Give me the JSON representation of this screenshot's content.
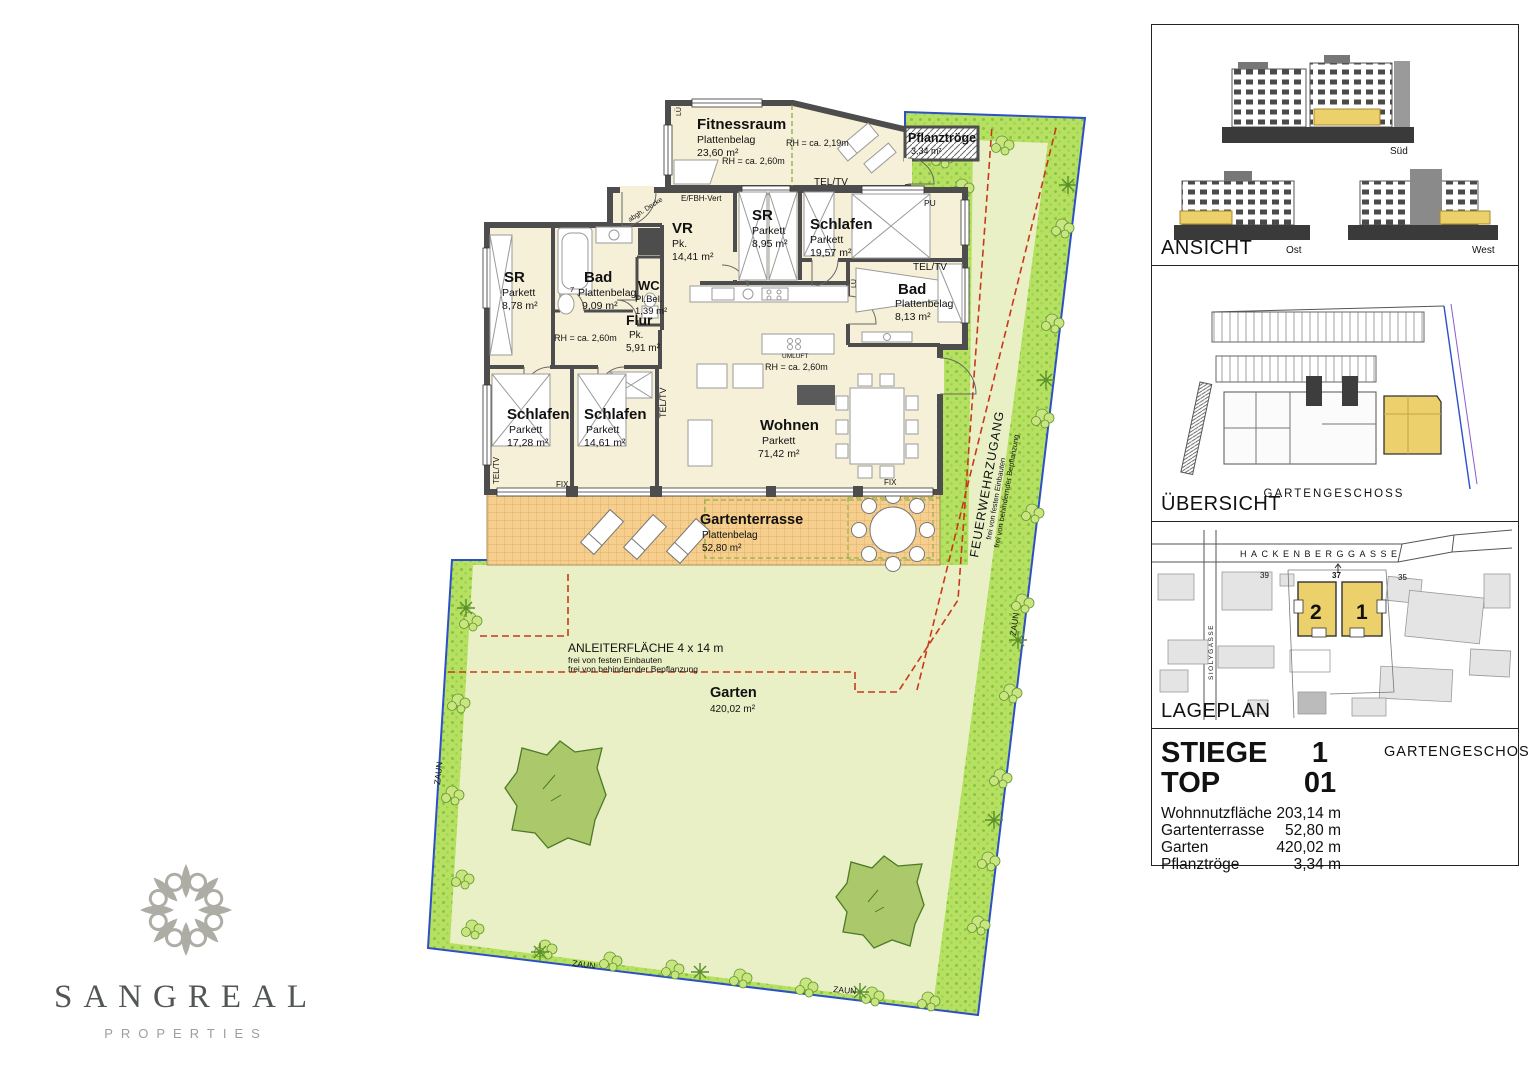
{
  "plan": {
    "rooms": {
      "fitnessraum": {
        "name": "Fitnessraum",
        "finish": "Plattenbelag",
        "area": "23,60 m²"
      },
      "vr": {
        "name": "VR",
        "finish": "Pk.",
        "area": "14,41 m²"
      },
      "sr_ost": {
        "name": "SR",
        "finish": "Parkett",
        "area": "8,95 m²"
      },
      "schlafen_ost": {
        "name": "Schlafen",
        "finish": "Parkett",
        "area": "19,57 m²"
      },
      "bad_ost": {
        "name": "Bad",
        "finish": "Plattenbelag",
        "area": "8,13 m²"
      },
      "sr_west": {
        "name": "SR",
        "finish": "Parkett",
        "area": "8,78 m²"
      },
      "bad_west": {
        "name": "Bad",
        "finish": "Plattenbelag",
        "area": "9,09 m²"
      },
      "wc": {
        "name": "WC",
        "finish": "Pl.Bel.",
        "area": "1,39 m²"
      },
      "flur": {
        "name": "Flur",
        "finish": "Pk.",
        "area": "5,91 m²"
      },
      "schlafen_sw": {
        "name": "Schlafen",
        "finish": "Parkett",
        "area": "17,28 m²"
      },
      "schlafen_mitte": {
        "name": "Schlafen",
        "finish": "Parkett",
        "area": "14,61 m²"
      },
      "wohnen": {
        "name": "Wohnen",
        "finish": "Parkett",
        "area": "71,42 m²"
      }
    },
    "notes": {
      "rh_219": "RH = ca. 2,19m",
      "rh_260": "RH = ca. 2,60m",
      "tel_tv": "TEL/TV",
      "fix": "FIX",
      "pu": "PU",
      "efbh": "E/FBH-Vert",
      "abgh_decke": "abgh. Decke",
      "umluft": "UMLUFT",
      "lue": "LÜ",
      "seven": "7"
    },
    "outdoor": {
      "terrasse": {
        "name": "Gartenterrasse",
        "finish": "Plattenbelag",
        "area": "52,80 m²"
      },
      "garten": {
        "name": "Garten",
        "area": "420,02 m²"
      },
      "pflanztroege": {
        "name": "Pflanztröge",
        "area": "3,34 m²"
      },
      "zaun": "ZAUN",
      "anleiter": {
        "title": "ANLEITERFLÄCHE 4 x 14 m",
        "line2": "frei von festen Einbauten",
        "line3": "frei von behindernder Bepflanzung"
      },
      "feuerwehr": {
        "title": "FEUERWEHRZUGANG",
        "line2": "frei von festen Einbauten",
        "line3": "frei von behindernder Bepflanzung"
      }
    }
  },
  "sidebar": {
    "ansicht": {
      "label": "ANSICHT",
      "sued": "Süd",
      "ost": "Ost",
      "west": "West"
    },
    "uebersicht": {
      "label": "ÜBERSICHT",
      "caption": "GARTENGESCHOSS"
    },
    "lageplan": {
      "label": "LAGEPLAN",
      "street_main": "HACKENBERGGASSE",
      "street_side": "SIOLYGASSE",
      "haus1": "1",
      "haus2": "2",
      "nr37": "37",
      "nr35": "35",
      "nr39": "39"
    },
    "info": {
      "stiege_label": "STIEGE",
      "stiege_value": "1",
      "geschoss": "GARTENGESCHOSS",
      "top_label": "TOP",
      "top_value": "01",
      "rows": [
        {
          "label": "Wohnnutzfläche",
          "value": "203,14 m"
        },
        {
          "label": "Gartenterrasse",
          "value": "52,80 m"
        },
        {
          "label": "Garten",
          "value": "420,02 m"
        },
        {
          "label": "Pflanztröge",
          "value": "3,34 m"
        }
      ]
    }
  },
  "branding": {
    "name": "SANGREAL",
    "tagline": "PROPERTIES"
  },
  "colors": {
    "room_fill": "#f7f0d8",
    "wall": "#4d4d4d",
    "lawn": "#e9f0c6",
    "garden_strip": "#b5e061",
    "terrace": "#f6cf8e",
    "red_marking": "#c8391b",
    "boundary_blue": "#2d50c8",
    "accent_yellow": "#ecd06c"
  }
}
